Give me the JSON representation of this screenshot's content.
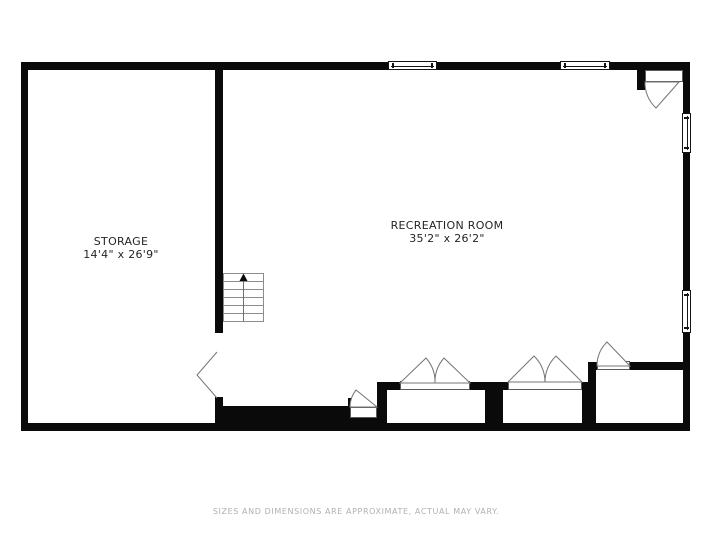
{
  "floorplan": {
    "rooms": [
      {
        "name": "STORAGE",
        "dimensions": "14'4\" x 26'9\""
      },
      {
        "name": "RECREATION ROOM",
        "dimensions": "35'2\" x 26'2\""
      }
    ],
    "disclaimer": "SIZES AND DIMENSIONS ARE APPROXIMATE, ACTUAL MAY VARY.",
    "stairs": {
      "treads": 6,
      "direction": "up"
    },
    "features": {
      "windows_top": 2,
      "windows_right": 2,
      "closets_with_double_doors": 2,
      "single_swing_doors": 3,
      "storage_doorway": 1
    },
    "colors": {
      "wall": "#0a0a0a",
      "room_label": "#252525",
      "disclaimer_text": "#b0b0b0",
      "door_line": "#757575",
      "stairs_line": "#8c8c8c",
      "background": "#ffffff"
    }
  }
}
